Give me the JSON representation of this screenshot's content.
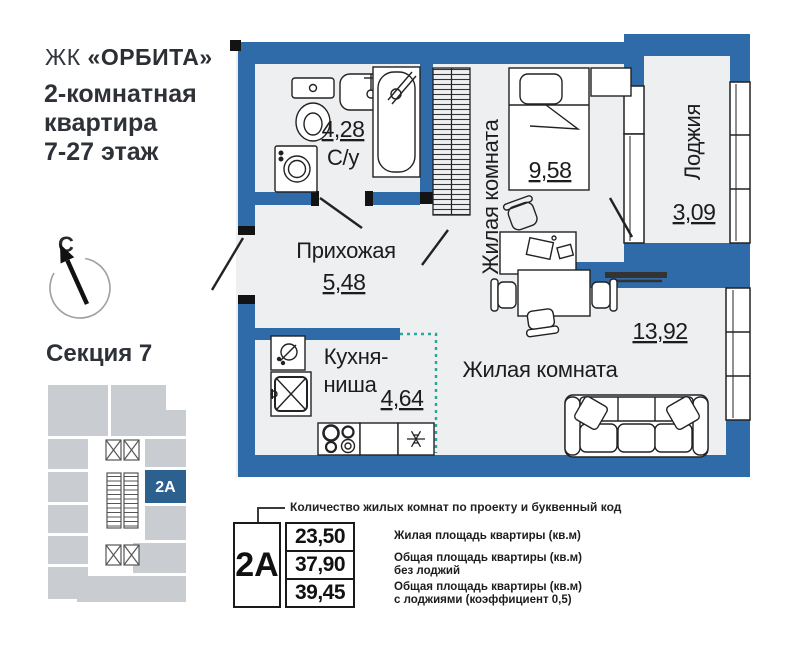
{
  "header": {
    "brand_prefix": "ЖК",
    "brand_name": "«ОРБИТА»",
    "subtitle_lines": [
      "2-комнатная",
      "квартира",
      "7-27 этаж"
    ]
  },
  "compass": {
    "north_label": "С"
  },
  "section": {
    "title": "Секция 7",
    "unit_code": "2А"
  },
  "plan": {
    "bathroom": {
      "area": "4,28",
      "name": "С/у"
    },
    "hallway": {
      "name": "Прихожая",
      "area": "5,48"
    },
    "bedroom": {
      "name": "Жилая комната",
      "area": "9,58"
    },
    "loggia": {
      "name": "Лоджия",
      "area": "3,09"
    },
    "kitchen": {
      "name_line1": "Кухня-",
      "name_line2": "ниша",
      "area": "4,64"
    },
    "living": {
      "name": "Жилая комната",
      "area": "13,92"
    }
  },
  "legend": {
    "callout": "Количество жилых комнат по проекту и буквенный код",
    "unit_code": "2А",
    "rows": [
      {
        "value": "23,50",
        "label": "Жилая площадь квартиры (кв.м)",
        "label2": ""
      },
      {
        "value": "37,90",
        "label": "Общая площадь квартиры (кв.м)",
        "label2": "без лоджий"
      },
      {
        "value": "39,45",
        "label": "Общая площадь квартиры (кв.м)",
        "label2": "с лоджиями (коэффициент 0,5)"
      }
    ]
  },
  "colors": {
    "wall_blue": "#2f6ba8",
    "floor_gray": "#edeff1",
    "unit_highlight_blue": "#2c608f",
    "kitchen_zone_teal": "#2aa79b",
    "section_gray": "#c9cdd2",
    "line_black": "#1c1c1e"
  }
}
